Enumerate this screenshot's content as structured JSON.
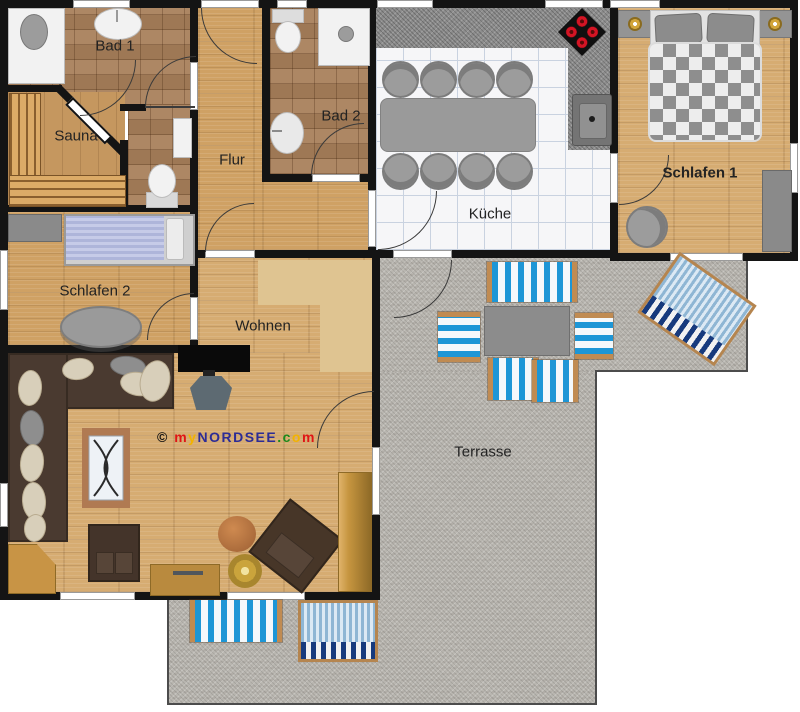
{
  "rooms": {
    "bad1": {
      "label": "Bad 1"
    },
    "sauna": {
      "label": "Sauna"
    },
    "flur": {
      "label": "Flur"
    },
    "bad2": {
      "label": "Bad 2"
    },
    "kueche": {
      "label": "Küche"
    },
    "schlafen1": {
      "label": "Schlafen 1"
    },
    "schlafen2": {
      "label": "Schlafen 2"
    },
    "wohnen": {
      "label": "Wohnen"
    },
    "terrasse": {
      "label": "Terrasse"
    }
  },
  "watermark": {
    "segments": [
      {
        "text": "© ",
        "color": "#111111"
      },
      {
        "text": "m",
        "color": "#e01515"
      },
      {
        "text": "y",
        "color": "#f2b300"
      },
      {
        "text": "NORDSEE",
        "color": "#2c2c96"
      },
      {
        "text": ".",
        "color": "#1b8a1b"
      },
      {
        "text": "c",
        "color": "#1b8a1b"
      },
      {
        "text": "o",
        "color": "#f2b300"
      },
      {
        "text": "m",
        "color": "#e01515"
      }
    ]
  },
  "furniture_icons": [
    "double-bed",
    "single-bed",
    "nightstand-lamp",
    "wardrobe",
    "corner-sofa",
    "armchair",
    "tv",
    "tv-stand",
    "coffee-table",
    "stool",
    "rug",
    "sideboard",
    "cabinet",
    "corner-desk",
    "dining-table",
    "chair",
    "round-table",
    "stove",
    "kitchen-sink",
    "washbasin",
    "toilet",
    "shower",
    "sauna-bench",
    "deck-chair",
    "beach-chair",
    "garden-table"
  ],
  "colors": {
    "wall": "#141414",
    "wood_floor": "#cfa164",
    "bath_tile": "#a8805a",
    "kitchen_tile": "#f6f6f8",
    "granite": "#8d8d8d",
    "terrace": "#b9b6b0",
    "deck_chair_blue": "#1d96d6",
    "beach_chair_navy": "#173a7d",
    "duvet_lavender": "#aeb5da"
  }
}
